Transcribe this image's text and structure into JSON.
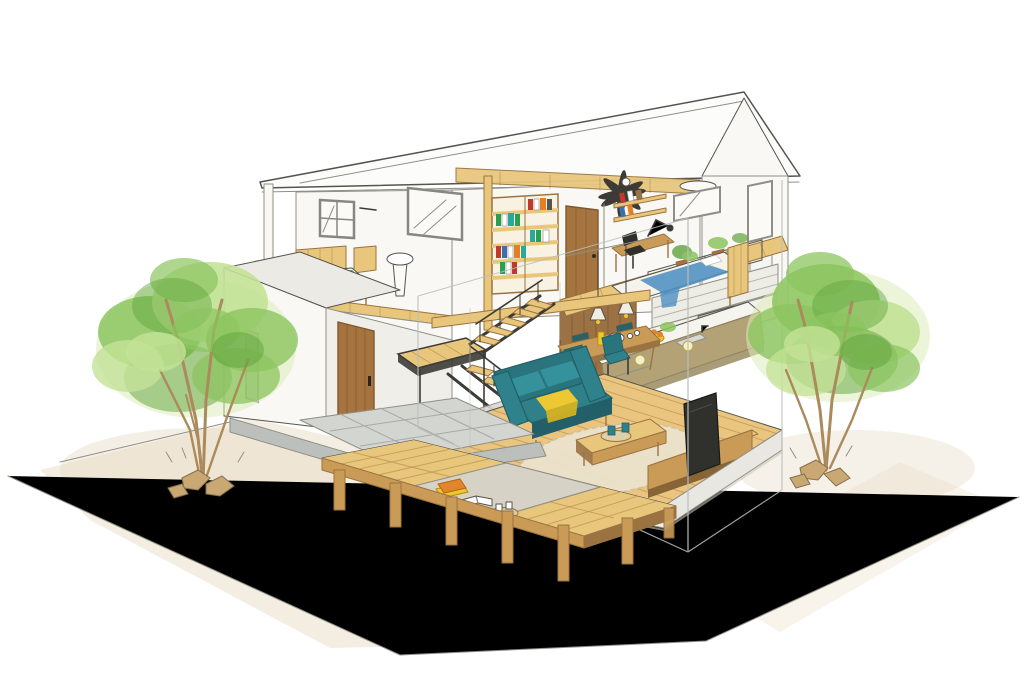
{
  "meta": {
    "kind": "hand-drawn watercolor architectural cutaway illustration",
    "subject": "two-story modern house with open interior, wood deck and two garden trees",
    "canvas": {
      "width": 1024,
      "height": 683
    },
    "visible_text": "none"
  },
  "palette": {
    "paper": "#ffffff",
    "line": "#55544e",
    "line_soft": "#908f86",
    "wall": "#f9f8f4",
    "wall_shade": "#efeee8",
    "roof": "#fcfcfa",
    "concrete": "#bcc0bc",
    "concrete2": "#c9ccc8",
    "stone": "#d3d5d0",
    "stone_line": "#a7aaa5",
    "wood_light": "#e8c77d",
    "wood_mid": "#c99b57",
    "wood_dark": "#9a7340",
    "wood_deep": "#7c5a2f",
    "wood_grain": "#b98d4e",
    "door": "#a6743f",
    "door_line": "#7e5730",
    "steel": "#3c3b36",
    "teal": "#2f8089",
    "teal_mid": "#2a747d",
    "teal_dark": "#235f68",
    "leaf": "#8cc45f",
    "leaf_light": "#c3e296",
    "leaf_dark": "#5fa33c",
    "leaf_pale": "#dcedb9",
    "trunk": "#ab8a5c",
    "rock": "#c9a873",
    "rock_line": "#86714a",
    "green_bed": "#2f9e50",
    "green_bed_dark": "#1f8a40",
    "blue_bed": "#4e8fc0",
    "yellow": "#eec832",
    "yellow_deep": "#d9b41f",
    "orange": "#e2862e",
    "rug": "#ece4d0",
    "rug_line": "#cdbfa2",
    "tv": "#30302c",
    "glass": "#b9beba",
    "ground": "#f1e9d9",
    "ground2": "#e7dcc5",
    "white_soft": "#fbfaf6",
    "island": "#b2a276",
    "island_edge": "#8f815c",
    "wood_wall": "#9c7144",
    "wood_wall_line": "#7d5a36",
    "book_red": "#c0392b",
    "book_teal": "#2aa8a0",
    "book_green": "#27a050",
    "book_blue": "#3a6fb0",
    "book_orange": "#e67e22",
    "pot": "#b46a45",
    "appliance": "#c2c2bc"
  },
  "scene": {
    "building": {
      "floors": 2,
      "roof": "long mono-pitch gable, white, peak at right",
      "structure": [
        "white walls drawn transparent",
        "exposed ceiling beam",
        "steel switchback staircase with wood treads",
        "wood loft floor joists over kitchen",
        "concrete foundation plinth"
      ]
    },
    "rooms": [
      {
        "name": "bedroom-left-upper",
        "items": [
          "four-pane-window",
          "wood-frame-bed",
          "green-bedding",
          "washbasin",
          "wood-slat-floor"
        ]
      },
      {
        "name": "stairwell",
        "items": [
          "bookshelf-with-colorful-books",
          "wood-door-upstairs",
          "clerestory-window",
          "steel-staircase",
          "landing-platform"
        ]
      },
      {
        "name": "loft-bedroom-right",
        "items": [
          "bed-with-blue-blanket",
          "wood-headboard",
          "desk",
          "black-desk-chair",
          "desk-lamp",
          "wall-shelves-with-books",
          "back-window",
          "side-windows",
          "ceiling-fan",
          "ceiling-light"
        ]
      },
      {
        "name": "kitchen",
        "items": [
          "wood-plank-feature-wall",
          "tile-backsplash",
          "back-cabinets",
          "range",
          "island-counter",
          "sink",
          "fruit-bowl",
          "hanging-shelf-with-plants"
        ]
      },
      {
        "name": "dining",
        "items": [
          "wood-table",
          "teal-chairs",
          "pendant-lights",
          "kettle",
          "yellow-bottle"
        ]
      },
      {
        "name": "living-room",
        "items": [
          "wood-plank-floor",
          "round-rug",
          "teal-sofa",
          "yellow-throw",
          "coffee-table",
          "tray-with-cups",
          "tv",
          "tv-stand"
        ]
      },
      {
        "name": "entry",
        "items": [
          "wood-front-door",
          "slit-window",
          "stone-tile-porch",
          "concrete-step"
        ]
      }
    ],
    "exterior": [
      "wood-deck-on-posts",
      "deck-cushion-orange",
      "open-book",
      "tray-with-two-cups",
      "tree-left",
      "tree-right",
      "landscape-rocks",
      "sketched-site-boundary",
      "beige-ground-wash"
    ]
  }
}
